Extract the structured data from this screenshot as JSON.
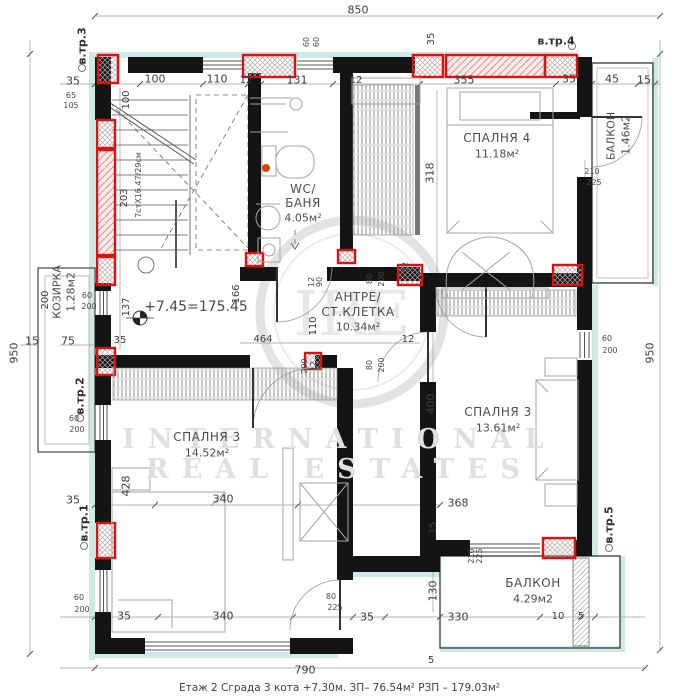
{
  "caption": "Етаж 2    Сграда 3 кота +7.30м.    ЗП– 76.54м²  РЗП – 179.03м²",
  "watermark": {
    "monogram": "IRE",
    "line1": "INTERNATIONAL",
    "line2": "REAL ESTATES"
  },
  "overall_dims": {
    "top": "850",
    "left": "950",
    "right": "950",
    "bottom": "790"
  },
  "rooms": [
    {
      "name": "СПАЛНЯ 4",
      "area": "11.18м²"
    },
    {
      "name": "WC/ БАНЯ",
      "area": "4.05м²"
    },
    {
      "name": "АНТРЕ/ СТ.КЛЕТКА",
      "area": "10.34м²"
    },
    {
      "name": "СПАЛНЯ 3",
      "area": "13.61м²"
    },
    {
      "name": "СПАЛНЯ 3",
      "area": "14.52м²"
    },
    {
      "name": "БАЛКОН",
      "area": "4.29м2"
    },
    {
      "name": "БАЛКОН",
      "area": "1.46м2"
    },
    {
      "name": "КОЗИРКА",
      "area": "1.28м2"
    }
  ],
  "elevation_mark": "+7.45=175.45",
  "stair_note": "7стX16.47/29см",
  "stair_refs": [
    "в.тр.1",
    "в.тр.2",
    "в.тр.3",
    "в.тр.4",
    "в.тр.5"
  ],
  "labels": [
    {
      "t": "850",
      "x": 358,
      "y": 10
    },
    {
      "t": "950",
      "x": 14,
      "y": 353,
      "cls": "v"
    },
    {
      "t": "950",
      "x": 650,
      "y": 353,
      "cls": "v"
    },
    {
      "t": "790",
      "x": 305,
      "y": 670
    },
    {
      "t": "5",
      "x": 431,
      "y": 661,
      "cls": "d10"
    },
    {
      "t": "в.тр.3",
      "x": 82,
      "y": 46,
      "cls": "ref v"
    },
    {
      "t": "в.тр.4",
      "x": 556,
      "y": 41,
      "cls": "ref"
    },
    {
      "t": "в.тр.2",
      "x": 80,
      "y": 396,
      "cls": "ref v"
    },
    {
      "t": "в.тр.1",
      "x": 84,
      "y": 523,
      "cls": "ref v"
    },
    {
      "t": "в.тр.5",
      "x": 609,
      "y": 525,
      "cls": "ref v"
    },
    {
      "t": "35",
      "x": 73,
      "y": 81
    },
    {
      "t": "100",
      "x": 155,
      "y": 79
    },
    {
      "t": "110",
      "x": 217,
      "y": 79
    },
    {
      "t": "12",
      "x": 246,
      "y": 81,
      "cls": "d10"
    },
    {
      "t": "131",
      "x": 297,
      "y": 80
    },
    {
      "t": "12",
      "x": 356,
      "y": 81,
      "cls": "d10"
    },
    {
      "t": "355",
      "x": 464,
      "y": 80
    },
    {
      "t": "35",
      "x": 569,
      "y": 79
    },
    {
      "t": "45",
      "x": 612,
      "y": 79
    },
    {
      "t": "15",
      "x": 644,
      "y": 80
    },
    {
      "t": "35",
      "x": 432,
      "y": 39,
      "cls": "v d10"
    },
    {
      "t": "60",
      "x": 307,
      "y": 42,
      "cls": "sm v"
    },
    {
      "t": "60",
      "x": 317,
      "y": 42,
      "cls": "sm v"
    },
    {
      "t": "65",
      "x": 71,
      "y": 96,
      "cls": "sm"
    },
    {
      "t": "105",
      "x": 71,
      "y": 106,
      "cls": "sm"
    },
    {
      "t": "100",
      "x": 127,
      "y": 100,
      "cls": "v d10"
    },
    {
      "t": "7стX16.47/29см",
      "x": 139,
      "y": 185,
      "cls": "sm v"
    },
    {
      "t": "203",
      "x": 125,
      "y": 198,
      "cls": "v d10"
    },
    {
      "t": "137",
      "x": 127,
      "y": 307,
      "cls": "v d10"
    },
    {
      "t": "166",
      "x": 237,
      "y": 294,
      "cls": "v d10"
    },
    {
      "t": "15",
      "x": 32,
      "y": 341
    },
    {
      "t": "75",
      "x": 68,
      "y": 341
    },
    {
      "t": "35",
      "x": 120,
      "y": 341,
      "cls": "d10"
    },
    {
      "t": "КОЗИРКА",
      "x": 57,
      "y": 292,
      "cls": "koz v"
    },
    {
      "t": "1.28м2",
      "x": 71,
      "y": 292,
      "cls": "koz v"
    },
    {
      "t": "200",
      "x": 46,
      "y": 300,
      "cls": "v d10"
    },
    {
      "t": "60",
      "x": 87,
      "y": 296,
      "cls": "sm"
    },
    {
      "t": "200",
      "x": 89,
      "y": 307,
      "cls": "sm"
    },
    {
      "t": "60",
      "x": 74,
      "y": 419,
      "cls": "sm"
    },
    {
      "t": "200",
      "x": 77,
      "y": 430,
      "cls": "sm"
    },
    {
      "t": "35",
      "x": 73,
      "y": 500
    },
    {
      "t": "428",
      "x": 126,
      "y": 486,
      "cls": "v"
    },
    {
      "t": "60",
      "x": 79,
      "y": 598,
      "cls": "sm"
    },
    {
      "t": "200",
      "x": 82,
      "y": 610,
      "cls": "sm"
    },
    {
      "t": "+7.45=175.45",
      "x": 196,
      "y": 307,
      "cls": "elev"
    },
    {
      "t": "464",
      "x": 263,
      "y": 340,
      "cls": "d10"
    },
    {
      "t": "12",
      "x": 312,
      "y": 282,
      "cls": "sm v"
    },
    {
      "t": "90",
      "x": 320,
      "y": 282,
      "cls": "sm v"
    },
    {
      "t": "110",
      "x": 314,
      "y": 326,
      "cls": "v d10"
    },
    {
      "t": "80",
      "x": 370,
      "y": 279,
      "cls": "sm v"
    },
    {
      "t": "200",
      "x": 382,
      "y": 279,
      "cls": "sm v"
    },
    {
      "t": "200",
      "x": 305,
      "y": 366,
      "cls": "sm v"
    },
    {
      "t": "12",
      "x": 314,
      "y": 366,
      "cls": "sm v"
    },
    {
      "t": "80",
      "x": 370,
      "y": 365,
      "cls": "sm v"
    },
    {
      "t": "200",
      "x": 382,
      "y": 365,
      "cls": "sm v"
    },
    {
      "t": "12",
      "x": 408,
      "y": 340,
      "cls": "d10"
    },
    {
      "t": "12",
      "x": 406,
      "y": 267,
      "cls": "sm v"
    },
    {
      "t": "WC/",
      "x": 303,
      "y": 189,
      "cls": "room"
    },
    {
      "t": "БАНЯ",
      "x": 303,
      "y": 203,
      "cls": "room"
    },
    {
      "t": "4.05м²",
      "x": 303,
      "y": 218,
      "cls": "area"
    },
    {
      "t": "АНТРЕ/",
      "x": 358,
      "y": 297,
      "cls": "room"
    },
    {
      "t": "СТ.КЛЕТКА",
      "x": 358,
      "y": 312,
      "cls": "room"
    },
    {
      "t": "10.34м²",
      "x": 358,
      "y": 327,
      "cls": "area"
    },
    {
      "t": "СПАЛНЯ 4",
      "x": 497,
      "y": 138,
      "cls": "room"
    },
    {
      "t": "11.18м²",
      "x": 497,
      "y": 154,
      "cls": "area"
    },
    {
      "t": "СПАЛНЯ 3",
      "x": 498,
      "y": 412,
      "cls": "room"
    },
    {
      "t": "13.61м²",
      "x": 498,
      "y": 428,
      "cls": "area"
    },
    {
      "t": "СПАЛНЯ 3",
      "x": 207,
      "y": 437,
      "cls": "room"
    },
    {
      "t": "14.52м²",
      "x": 207,
      "y": 453,
      "cls": "area"
    },
    {
      "t": "БАЛКОН",
      "x": 533,
      "y": 583,
      "cls": "room"
    },
    {
      "t": "4.29м2",
      "x": 533,
      "y": 599,
      "cls": "area"
    },
    {
      "t": "БАЛКОН",
      "x": 611,
      "y": 136,
      "cls": "roomv v"
    },
    {
      "t": "1.46м2",
      "x": 626,
      "y": 135,
      "cls": "roomv v"
    },
    {
      "t": "318",
      "x": 430,
      "y": 173,
      "cls": "v"
    },
    {
      "t": "210",
      "x": 592,
      "y": 172,
      "cls": "sm"
    },
    {
      "t": "225",
      "x": 594,
      "y": 183,
      "cls": "sm"
    },
    {
      "t": "400",
      "x": 431,
      "y": 404,
      "cls": "v"
    },
    {
      "t": "60",
      "x": 607,
      "y": 339,
      "cls": "sm"
    },
    {
      "t": "200",
      "x": 610,
      "y": 351,
      "cls": "sm"
    },
    {
      "t": "368",
      "x": 458,
      "y": 503
    },
    {
      "t": "35",
      "x": 434,
      "y": 528,
      "cls": "v d10"
    },
    {
      "t": "130",
      "x": 433,
      "y": 591,
      "cls": "v"
    },
    {
      "t": "330",
      "x": 458,
      "y": 617
    },
    {
      "t": "10",
      "x": 558,
      "y": 617,
      "cls": "d10"
    },
    {
      "t": "5",
      "x": 581,
      "y": 617,
      "cls": "d10"
    },
    {
      "t": "210",
      "x": 472,
      "y": 556,
      "cls": "sm v"
    },
    {
      "t": "225",
      "x": 480,
      "y": 556,
      "cls": "sm v"
    },
    {
      "t": "80",
      "x": 331,
      "y": 597,
      "cls": "sm"
    },
    {
      "t": "225",
      "x": 335,
      "y": 608,
      "cls": "sm"
    },
    {
      "t": "35",
      "x": 124,
      "y": 616
    },
    {
      "t": "340",
      "x": 223,
      "y": 616
    },
    {
      "t": "35",
      "x": 367,
      "y": 617
    },
    {
      "t": "340",
      "x": 223,
      "y": 499
    }
  ]
}
